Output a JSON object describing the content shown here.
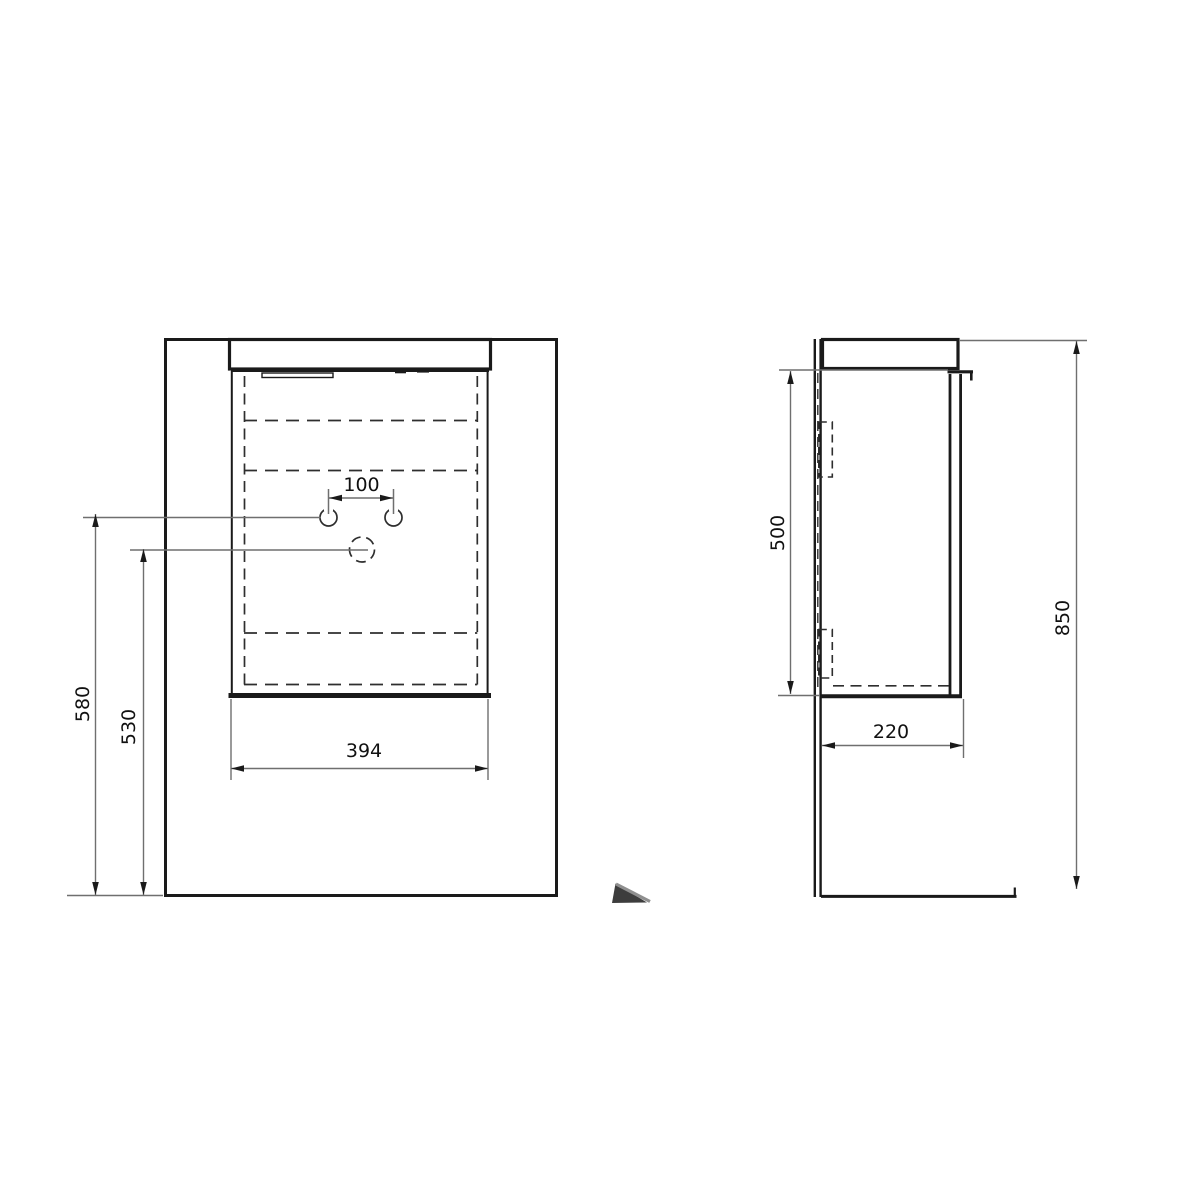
{
  "drawing": {
    "front_view": {
      "hole_spacing": "100",
      "cabinet_width": "394",
      "faucet_holes_height": "580",
      "drain_height": "530"
    },
    "side_view": {
      "body_height": "500",
      "overall_height": "850",
      "depth": "220"
    },
    "colors": {
      "outline": "#1a1a1a",
      "interior_dashed": "#2e2e2e",
      "dimension_line": "#6f6f6f",
      "label_text": "#111111",
      "background": "#ffffff",
      "wedge_dark": "#3d3d3d",
      "wedge_highlight": "#8f8f8f"
    }
  }
}
